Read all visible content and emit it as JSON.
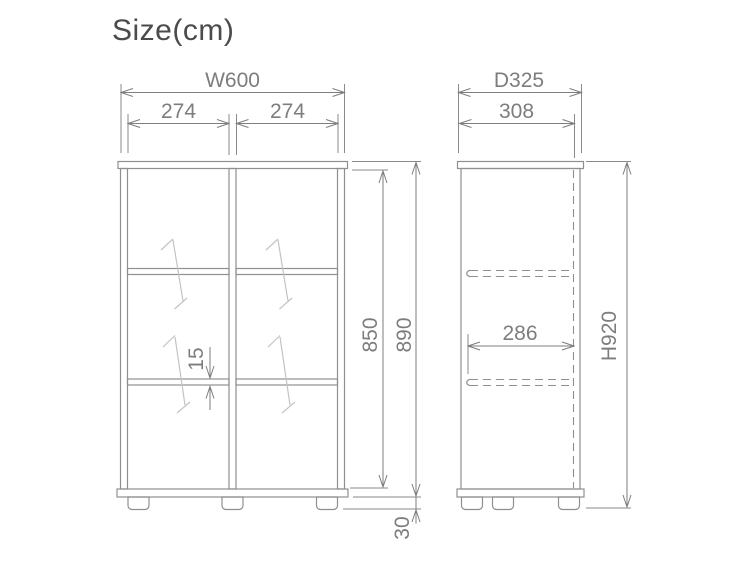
{
  "title": "Size(cm)",
  "colors": {
    "background": "#ffffff",
    "furniture_line": "#8f8f8f",
    "dimension_line": "#7e7e7e",
    "dimension_text": "#7d7d7d",
    "title_text": "#4b4b4b",
    "glass_mark": "#c3c3c3"
  },
  "front_view": {
    "dimensions": {
      "overall_width": "W600",
      "left_opening_width": "274",
      "right_opening_width": "274",
      "shelf_thickness": "15",
      "interior_height": "850",
      "body_height": "890",
      "leg_height": "30"
    }
  },
  "side_view": {
    "dimensions": {
      "overall_depth": "D325",
      "top_depth": "308",
      "shelf_depth": "286",
      "overall_height": "H920"
    }
  }
}
